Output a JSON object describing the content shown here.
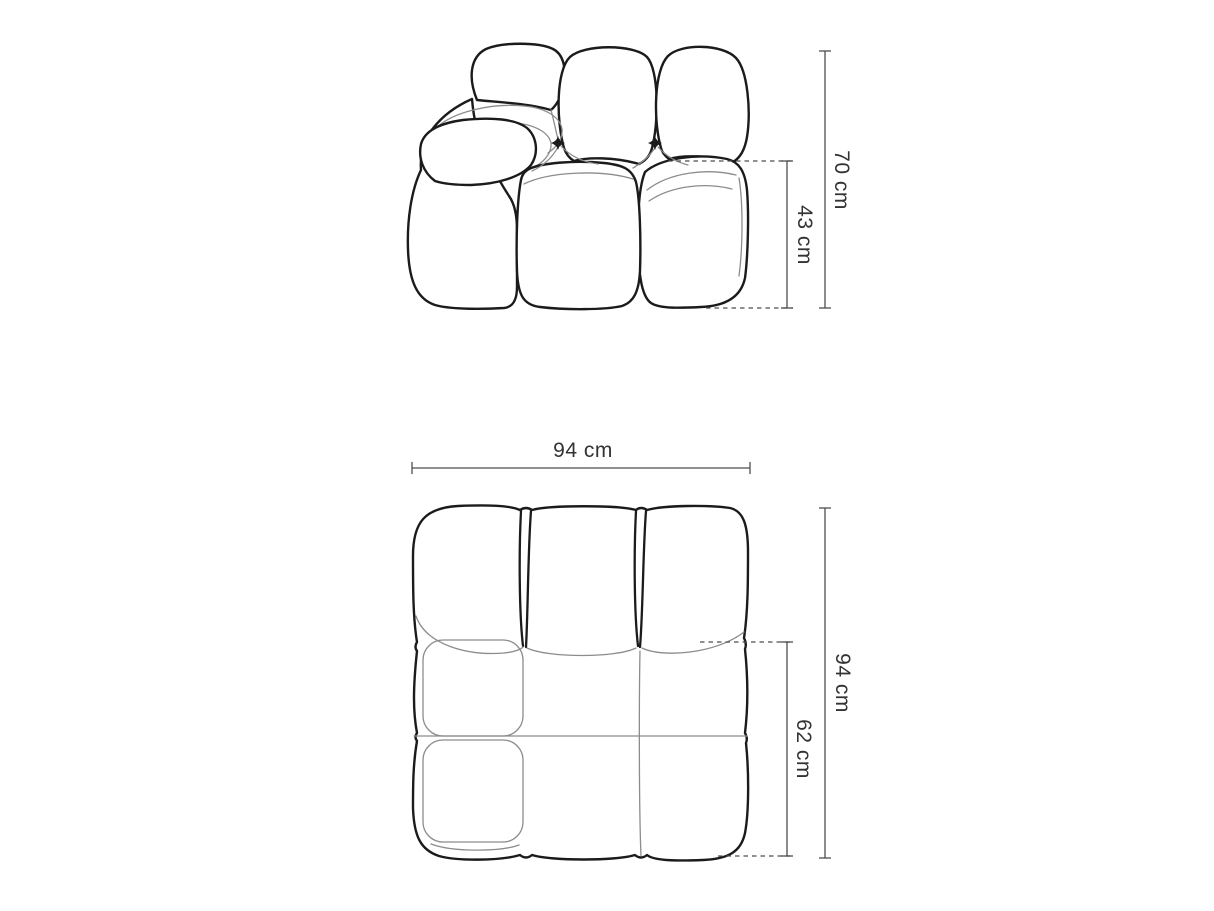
{
  "colors": {
    "background": "#ffffff",
    "outline": "#1b1b1b",
    "seam": "#8c8c8c",
    "dimension_line": "#4d4d4d",
    "label_text": "#333333"
  },
  "side_view": {
    "labels": {
      "total_height": "70 cm",
      "seat_height": "43 cm"
    }
  },
  "top_view": {
    "labels": {
      "width": "94 cm",
      "total_depth": "94 cm",
      "seat_depth": "62 cm"
    }
  }
}
